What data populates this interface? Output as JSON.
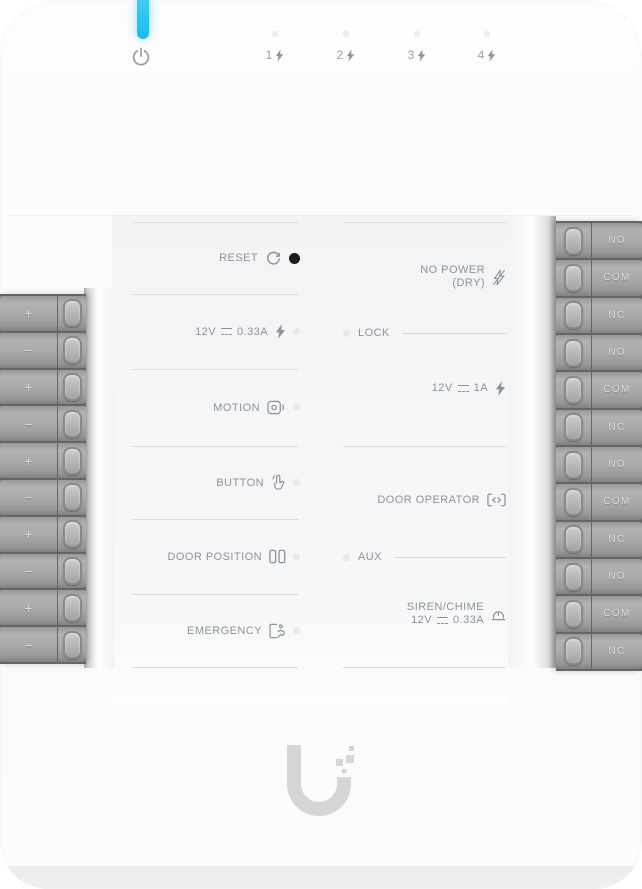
{
  "status_bar": {
    "channels": [
      "1",
      "2",
      "3",
      "4"
    ]
  },
  "left_column": {
    "reset_label": "RESET",
    "power_out": {
      "voltage": "12V",
      "current": "0.33A"
    },
    "motion_label": "MOTION",
    "button_label": "BUTTON",
    "door_position_label": "DOOR POSITION",
    "emergency_label": "EMERGENCY"
  },
  "right_column": {
    "no_power_line1": "NO POWER",
    "no_power_line2": "(DRY)",
    "lock_label": "LOCK",
    "lock_power": {
      "voltage": "12V",
      "current": "1A"
    },
    "door_operator_label": "DOOR OPERATOR",
    "aux_label": "AUX",
    "siren_label": "SIREN/CHIME",
    "siren_power": {
      "voltage": "12V",
      "current": "0.33A"
    }
  },
  "terminals": {
    "left": [
      "+",
      "−",
      "+",
      "−",
      "+",
      "−",
      "+",
      "−",
      "+",
      "−"
    ],
    "right": [
      "NO",
      "COM",
      "NC",
      "NO",
      "COM",
      "NC",
      "NO",
      "COM",
      "NC",
      "NO",
      "COM",
      "NC"
    ]
  },
  "icons": {
    "top": [
      "power-icon",
      "bolt-icon"
    ],
    "left_rows": [
      "reset-icon",
      "bolt-icon",
      "motion-sensor-icon",
      "button-press-icon",
      "door-position-icon",
      "emergency-exit-icon"
    ],
    "right_rows": [
      "no-power-bolt-icon",
      "bolt-icon",
      "door-operator-icon",
      "siren-chime-icon"
    ],
    "other": [
      "dc-symbol-icon",
      "screw-terminal",
      "status-led",
      "ubiquiti-logo"
    ]
  },
  "colors": {
    "led_blue": "#2bc6f3",
    "label_text": "#8d9297",
    "terminal_body": "#a7a8a9",
    "terminal_label": "#d9dadb",
    "divider_line": "#d9dadc",
    "logo_gray": "#d3d5d6",
    "reset_dot": "#1c1d1f"
  }
}
